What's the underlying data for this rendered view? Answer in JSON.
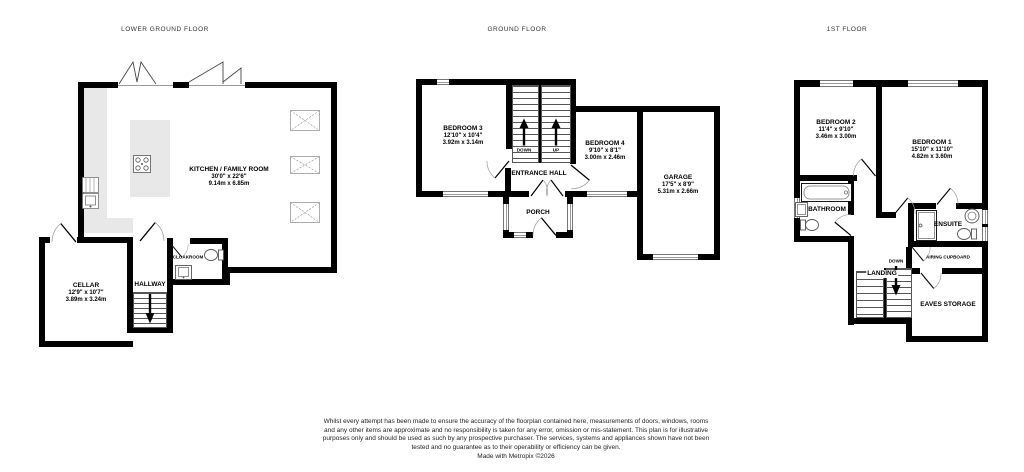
{
  "lgf": {
    "title": "LOWER GROUND FLOOR",
    "kitchen": {
      "name": "KITCHEN / FAMILY ROOM",
      "ft": "30'0\" x 22'6\"",
      "m": "9.14m x 6.85m"
    },
    "cellar": {
      "name": "CELLAR",
      "ft": "12'9\" x 10'7\"",
      "m": "3.89m x 3.24m"
    },
    "hallway": {
      "name": "HALLWAY"
    },
    "cloakroom": {
      "name": "CLOAKROOM"
    }
  },
  "gf": {
    "title": "GROUND FLOOR",
    "bedroom3": {
      "name": "BEDROOM 3",
      "ft": "12'10\" x 10'4\"",
      "m": "3.92m x 3.14m"
    },
    "bedroom4": {
      "name": "BEDROOM 4",
      "ft": "9'10\" x 8'1\"",
      "m": "3.00m x 2.46m"
    },
    "entrance_hall": {
      "name": "ENTRANCE HALL"
    },
    "porch": {
      "name": "PORCH"
    },
    "garage": {
      "name": "GARAGE",
      "ft": "17'5\" x 8'9\"",
      "m": "5.31m x 2.66m"
    },
    "down_label": "DOWN",
    "up_label": "UP"
  },
  "ff": {
    "title": "1ST FLOOR",
    "bedroom2": {
      "name": "BEDROOM 2",
      "ft": "11'4\" x 9'10\"",
      "m": "3.46m x 3.00m"
    },
    "bedroom1": {
      "name": "BEDROOM 1",
      "ft": "15'10\" x 11'10\"",
      "m": "4.82m x 3.60m"
    },
    "bathroom": {
      "name": "BATHROOM"
    },
    "ensuite": {
      "name": "ENSUITE"
    },
    "landing": {
      "name": "LANDING"
    },
    "airing": {
      "name": "AIRING CUPBOARD"
    },
    "eaves": {
      "name": "EAVES STORAGE"
    },
    "down_label": "DOWN"
  },
  "footer": {
    "disclaimer": "Whilst every attempt has been made to ensure the accuracy of the floorplan contained here, measurements of doors, windows, rooms and any other items are approximate and no responsibility is taken for any error, omission or mis-statement. This plan is for illustrative purposes only and should be used as such by any prospective purchaser. The services, systems and appliances shown have not been tested and no guarantee as to their operability or efficiency can be given.",
    "made_with": "Made with Metropix ©2026"
  }
}
